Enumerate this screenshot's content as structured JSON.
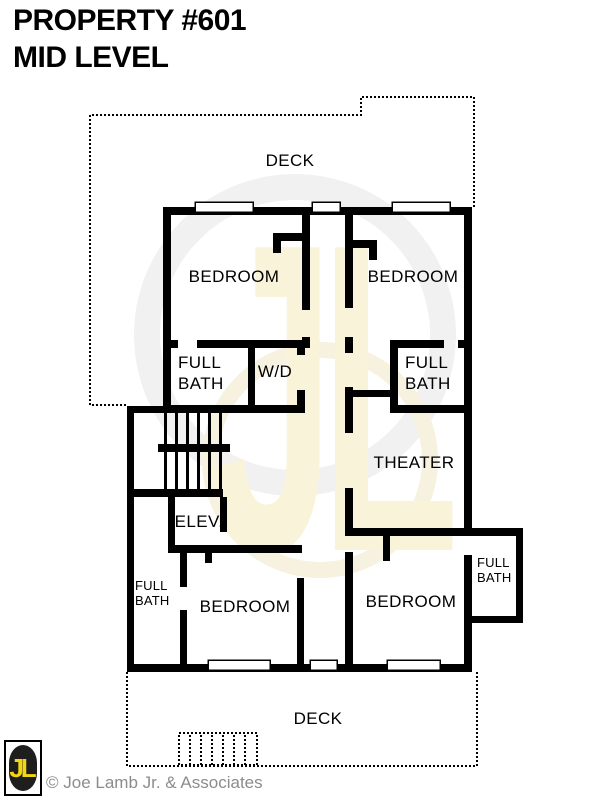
{
  "header": {
    "title_line1": "PROPERTY #601",
    "title_line2": "MID LEVEL"
  },
  "plan": {
    "rooms": [
      {
        "id": "deck-top",
        "label": "DECK"
      },
      {
        "id": "bedroom-top-left",
        "label": "BEDROOM"
      },
      {
        "id": "bedroom-top-right",
        "label": "BEDROOM"
      },
      {
        "id": "full-bath-left",
        "label": "FULL\nBATH"
      },
      {
        "id": "laundry",
        "label": "W/D"
      },
      {
        "id": "full-bath-right",
        "label": "FULL\nBATH"
      },
      {
        "id": "theater",
        "label": "THEATER"
      },
      {
        "id": "elevator",
        "label": "ELEV."
      },
      {
        "id": "full-bath-bottom-left",
        "label": "FULL\nBATH"
      },
      {
        "id": "bedroom-bottom-left",
        "label": "BEDROOM"
      },
      {
        "id": "bedroom-bottom-right",
        "label": "BEDROOM"
      },
      {
        "id": "full-bath-bottom-right",
        "label": "FULL\nBATH"
      },
      {
        "id": "deck-bottom",
        "label": "DECK"
      }
    ]
  },
  "watermark": {
    "text": "JL"
  },
  "logo": {
    "monogram": "JL",
    "background": "#1e1e1e",
    "letter_color": "#f2d513"
  },
  "footer": {
    "copyright": "© Joe Lamb Jr. & Associates",
    "text_color": "#8c8c8c"
  },
  "colors": {
    "wall": "#000000",
    "background": "#ffffff",
    "watermark_cream": "#f9f3da",
    "watermark_gray": "#f1f1f1",
    "watermark_gold": "#f7f2e0"
  }
}
